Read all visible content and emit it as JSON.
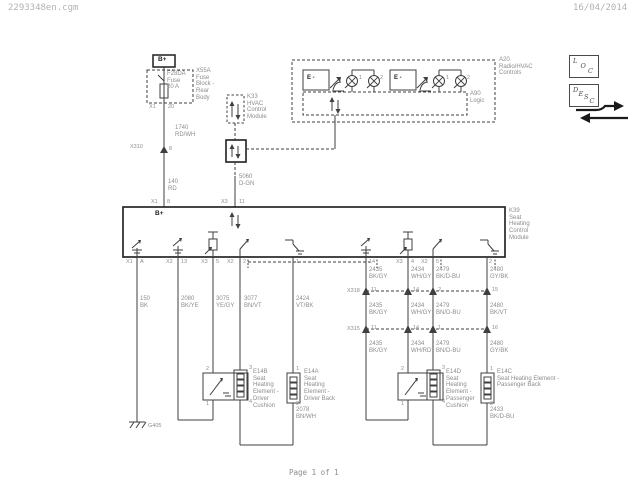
{
  "header": {
    "filename": "2293348en.cgm",
    "date": "16/04/2014"
  },
  "footer": {
    "page_label": "Page 1 of 1"
  },
  "toolbar": {
    "loc_label": "LOC",
    "desc_label": "DESC"
  },
  "colors": {
    "line": "#3f3f3f",
    "module_line": "#1f1f1f",
    "label_gray": "#8d8d8d",
    "dark_text": "#1f1f1f"
  },
  "diagram": {
    "power": {
      "bplus": "B+",
      "fuse": "F28DA\nFuse\n20 A",
      "fuse_block": "X55A\nFuse\nBlock -\nRear\nBody",
      "fuse_pin_conn": "X1",
      "fuse_pin_num": "20",
      "wire_1740": "1740\nRD/WH",
      "x310_label": "X310",
      "x310_pin": "8",
      "wire_140": "140\nRD"
    },
    "hvac": {
      "a20_label": "A20\nRadio/HVAC\nControls",
      "logic_label": "A90\nLogic",
      "switch1": "E -",
      "switch2": "E -",
      "lamp_nums": [
        "1",
        "2",
        "1",
        "2"
      ],
      "k33_label": "K33\nHVAC\nControl\nModule",
      "wire_5060": "5060\nD-GN"
    },
    "k39": {
      "label": "K39\nSeat\nHeating\nControl\nModule",
      "top_pin1_conn": "X1",
      "top_pin1_num": "8",
      "bplus": "B+",
      "top_pin2_conn": "X3",
      "top_pin2_num": "11",
      "bottom_pins": [
        {
          "conn": "X1",
          "num": "A"
        },
        {
          "conn": "X2",
          "num": "13"
        },
        {
          "conn": "X3",
          "num": "5"
        },
        {
          "conn": "X2",
          "num": "2"
        },
        {
          "num": "1"
        },
        {
          "num": "14"
        },
        {
          "conn": "X3",
          "num": "4"
        },
        {
          "conn": "X2",
          "num": "5"
        },
        {
          "num": "2"
        }
      ]
    },
    "left_wires": [
      "150\nBK",
      "2080\nBK/YE",
      "3075\nYE/GY",
      "3077\nBN/VT",
      "2424\nVT/BK"
    ],
    "right_wires": {
      "row1": [
        "2435\nBK/GY",
        "2434\nWH/GY",
        "2479\nBK/D-BU",
        "2480\nGY/BK"
      ],
      "row2": [
        "2435\nBK/GY",
        "2434\nWH/GY",
        "2479\nBN/D-BU",
        "2480\nBK/VT"
      ],
      "row3": [
        "2435\nBK/GY",
        "2434\nWH/RD",
        "2479\nBN/D-BU",
        "2480\nGY/BK"
      ]
    },
    "connectors": {
      "x318": {
        "label": "X318",
        "pins": [
          "11",
          "14",
          "2",
          "15"
        ]
      },
      "x315": {
        "label": "X315",
        "pins": [
          "11",
          "14",
          "1",
          "16"
        ]
      }
    },
    "elements": {
      "e14b": {
        "label": "E14B\nSeat\nHeating\nElement -\nDriver\nCushion",
        "pin_top": "2",
        "pin_bottom": "1",
        "heat_top": "3",
        "heat_bottom": "4"
      },
      "e14a": {
        "label": "E14A\nSeat\nHeating\nElement -\nDriver Back",
        "pin_top": "1",
        "pin_bottom": "2"
      },
      "e14d": {
        "label": "E14D\nSeat\nHeating\nElement -\nPassenger\nCushion",
        "pin_top": "2",
        "pin_bottom": "1",
        "heat_top": "3",
        "heat_bottom": "4"
      },
      "e14c": {
        "label": "E14C\nSeat Heating Element -\nPassenger Back",
        "pin_top": "1",
        "pin_bottom": "2"
      },
      "wire_2078": "2078\nBN/WH",
      "wire_2433": "2433\nBK/D-BU"
    },
    "ground": {
      "label": "G405"
    }
  }
}
